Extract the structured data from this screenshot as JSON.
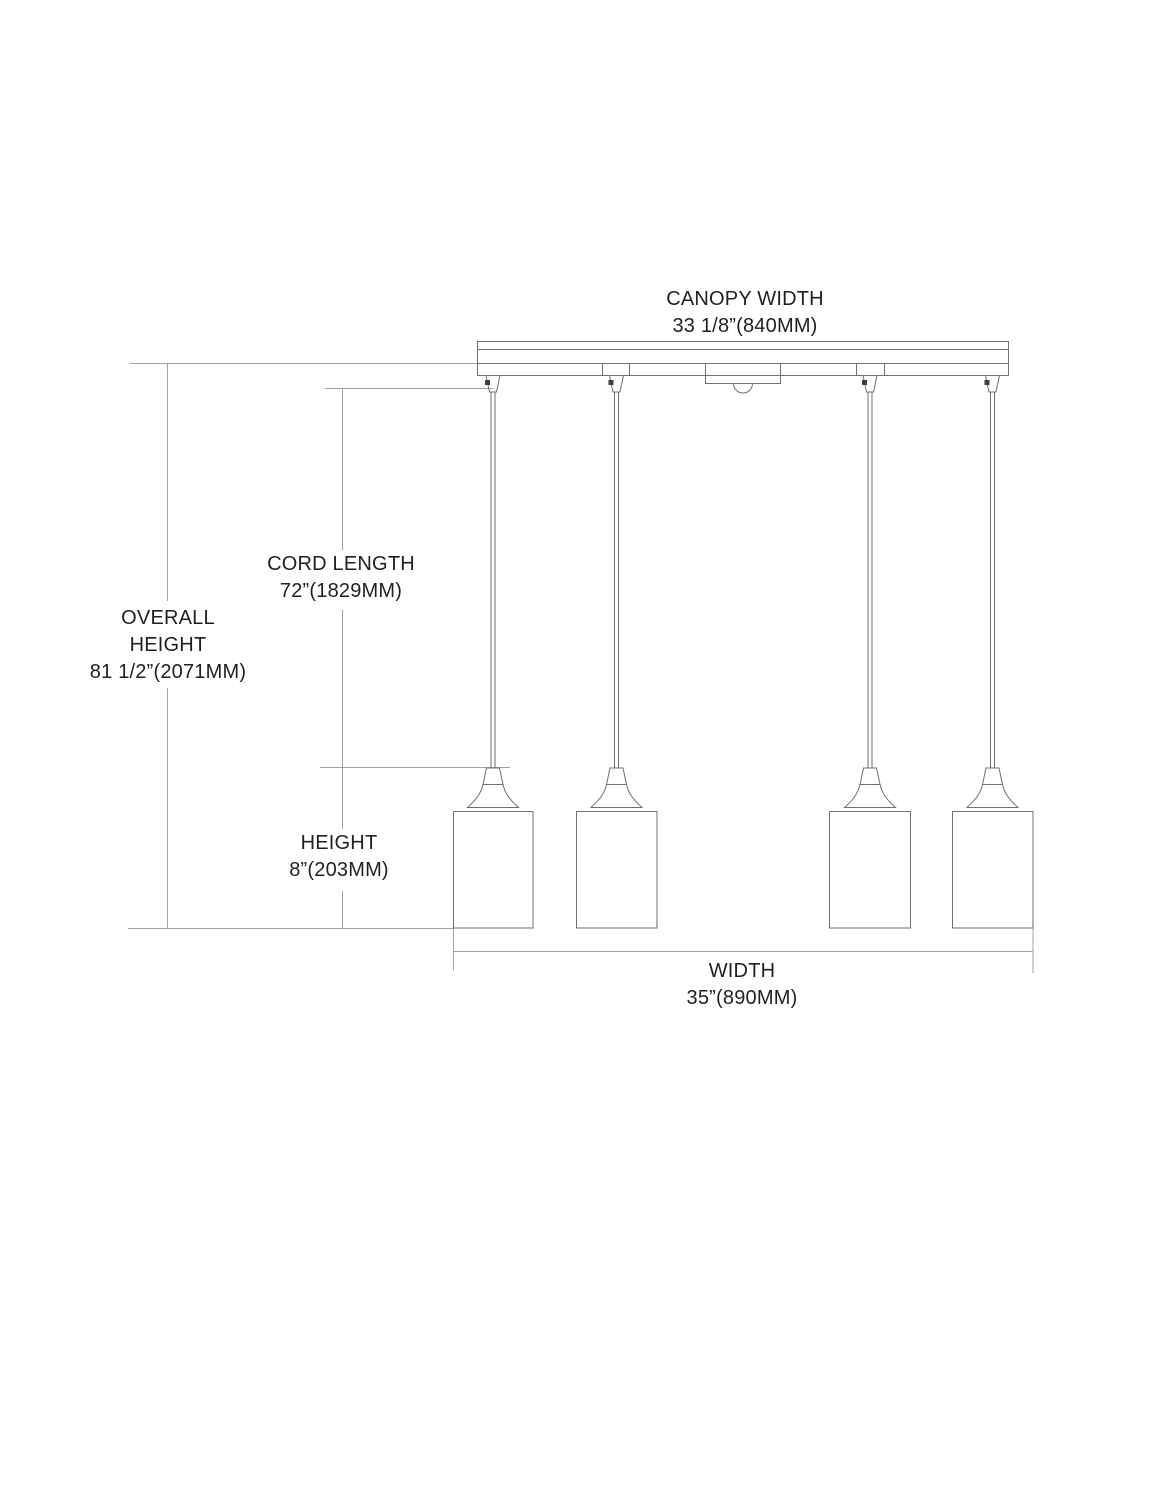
{
  "diagram": {
    "type": "pendant-light-dimension-drawing",
    "pendant_count": 4,
    "colors": {
      "fixture_line": "#6e6f72",
      "dimension_line": "#a0a2a5",
      "text": "#231f20",
      "background": "#ffffff"
    },
    "labels": {
      "canopy_width": {
        "title": "CANOPY WIDTH",
        "value": "33 1/8”(840MM)"
      },
      "cord_length": {
        "title": "CORD LENGTH",
        "value": "72”(1829MM)"
      },
      "overall_height": {
        "title_line1": "OVERALL",
        "title_line2": "HEIGHT",
        "value": "81 1/2”(2071MM)"
      },
      "height": {
        "title": "HEIGHT",
        "value": "8”(203MM)"
      },
      "width": {
        "title": "WIDTH",
        "value": "35”(890MM)"
      }
    }
  }
}
